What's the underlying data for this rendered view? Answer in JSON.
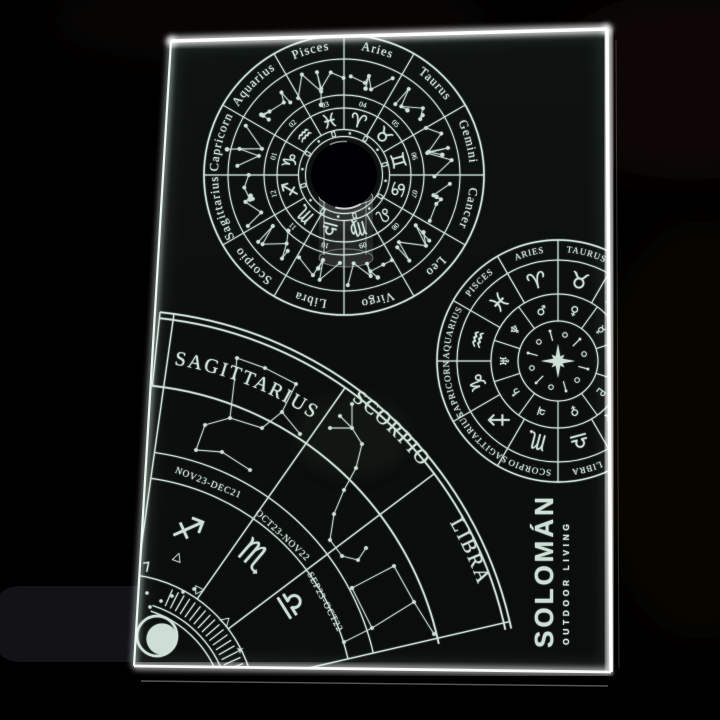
{
  "colors": {
    "engraving": "#d9ece3",
    "engraving_dim": "#c2d8ce",
    "led_edge": "#ffffff",
    "panel": "#0b0e0c",
    "background": "#000000"
  },
  "brand": {
    "name": "SOLOMÁN",
    "tagline": "OUTDOOR LIVING"
  },
  "top_wheel": {
    "signs": [
      {
        "name": "Aries",
        "symbol": "♈",
        "month": "04"
      },
      {
        "name": "Taurus",
        "symbol": "♉",
        "month": "05"
      },
      {
        "name": "Gemini",
        "symbol": "♊",
        "month": "06"
      },
      {
        "name": "Cancer",
        "symbol": "♋",
        "month": "07"
      },
      {
        "name": "Leo",
        "symbol": "♌",
        "month": "08"
      },
      {
        "name": "Virgo",
        "symbol": "♍",
        "month": "09"
      },
      {
        "name": "Libra",
        "symbol": "♎",
        "month": "10"
      },
      {
        "name": "Scorpio",
        "symbol": "♏",
        "month": "11"
      },
      {
        "name": "Sagittarius",
        "symbol": "♐",
        "month": "12"
      },
      {
        "name": "Capricorn",
        "symbol": "♑",
        "month": "01"
      },
      {
        "name": "Aquarius",
        "symbol": "♒",
        "month": "02"
      },
      {
        "name": "Pisces",
        "symbol": "♓",
        "month": "03"
      }
    ]
  },
  "side_wheel": {
    "signs": [
      {
        "name": "ARIES",
        "symbol": "♈"
      },
      {
        "name": "TAURUS",
        "symbol": "♉"
      },
      {
        "name": "GEMINI",
        "symbol": "♊"
      },
      {
        "name": "CANCER",
        "symbol": "♋"
      },
      {
        "name": "LEO",
        "symbol": "♌"
      },
      {
        "name": "VIRGO",
        "symbol": "♍"
      },
      {
        "name": "LIBRA",
        "symbol": "♎"
      },
      {
        "name": "SCORPIO",
        "symbol": "♏"
      },
      {
        "name": "SAGITTARIUS",
        "symbol": "♐"
      },
      {
        "name": "CAPRICORN",
        "symbol": "♑"
      },
      {
        "name": "AQUARIUS",
        "symbol": "♒"
      },
      {
        "name": "PISCES",
        "symbol": "♓"
      }
    ],
    "planets": [
      "♀",
      "☿",
      "☽",
      "♇",
      "♀",
      "♃",
      "♄",
      "♅",
      "♆",
      "♂"
    ]
  },
  "fan": {
    "sectors": [
      {
        "name": "SAGITTARIUS",
        "symbol": "♐",
        "dates": "NOV23-DEC21"
      },
      {
        "name": "SCORPIO",
        "symbol": "♏",
        "dates": "OCT23-NOV22"
      },
      {
        "name": "LIBRA",
        "symbol": "♎",
        "dates": "SEP23-OCT22"
      }
    ],
    "decor_marks": [
      "7",
      "△",
      "▷",
      "◁",
      "✶"
    ]
  }
}
